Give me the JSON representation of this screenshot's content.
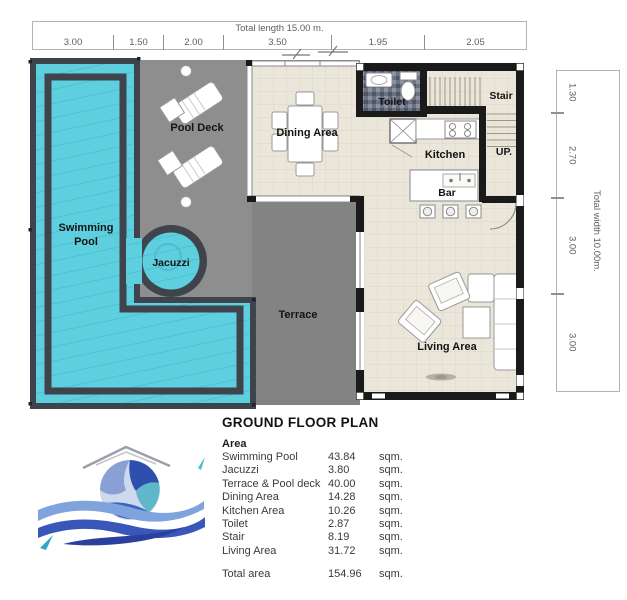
{
  "title": "GROUND FLOOR PLAN",
  "dimensions": {
    "top": {
      "label": "Total length 15.00 m.",
      "segments": [
        "3.00",
        "1.50",
        "2.00",
        "3.50",
        "1.95",
        "2.05"
      ]
    },
    "right": {
      "label": "Total width 10.00m.",
      "segments": [
        "1.30",
        "2.70",
        "3.00",
        "3.00"
      ]
    }
  },
  "plan": {
    "rooms": {
      "swimming_1": "Swimming",
      "swimming_2": "Pool",
      "pool_deck": "Pool Deck",
      "jacuzzi": "Jacuzzi",
      "terrace": "Terrace",
      "dining": "Dining Area",
      "toilet": "Toilet",
      "kitchen": "Kitchen",
      "bar": "Bar",
      "stair": "Stair",
      "up": "UP.",
      "living": "Living Area"
    }
  },
  "area_table": {
    "heading": "Area",
    "rows": [
      {
        "label": "Swimming Pool",
        "value": "43.84",
        "unit": "sqm."
      },
      {
        "label": "Jacuzzi",
        "value": "3.80",
        "unit": "sqm."
      },
      {
        "label": "Terrace & Pool deck",
        "value": "40.00",
        "unit": "sqm."
      },
      {
        "label": "Dining Area",
        "value": "14.28",
        "unit": "sqm."
      },
      {
        "label": "Kitchen Area",
        "value": "10.26",
        "unit": "sqm."
      },
      {
        "label": "Toilet",
        "value": "2.87",
        "unit": "sqm."
      },
      {
        "label": "Stair",
        "value": "8.19",
        "unit": "sqm."
      },
      {
        "label": "Living Area",
        "value": "31.72",
        "unit": "sqm."
      }
    ],
    "total": {
      "label": "Total area",
      "value": "154.96",
      "unit": "sqm."
    }
  },
  "theme": {
    "pool": "#5ecfdf",
    "pool-line": "#45b8cb",
    "deck": "#8e8e8e",
    "terrace": "#838383",
    "floor": "#eae6da",
    "wall": "#1a1a1a",
    "frame": "#3f444c",
    "dim-text": "#5f5f5f",
    "logo-blue": "#3857b8"
  }
}
